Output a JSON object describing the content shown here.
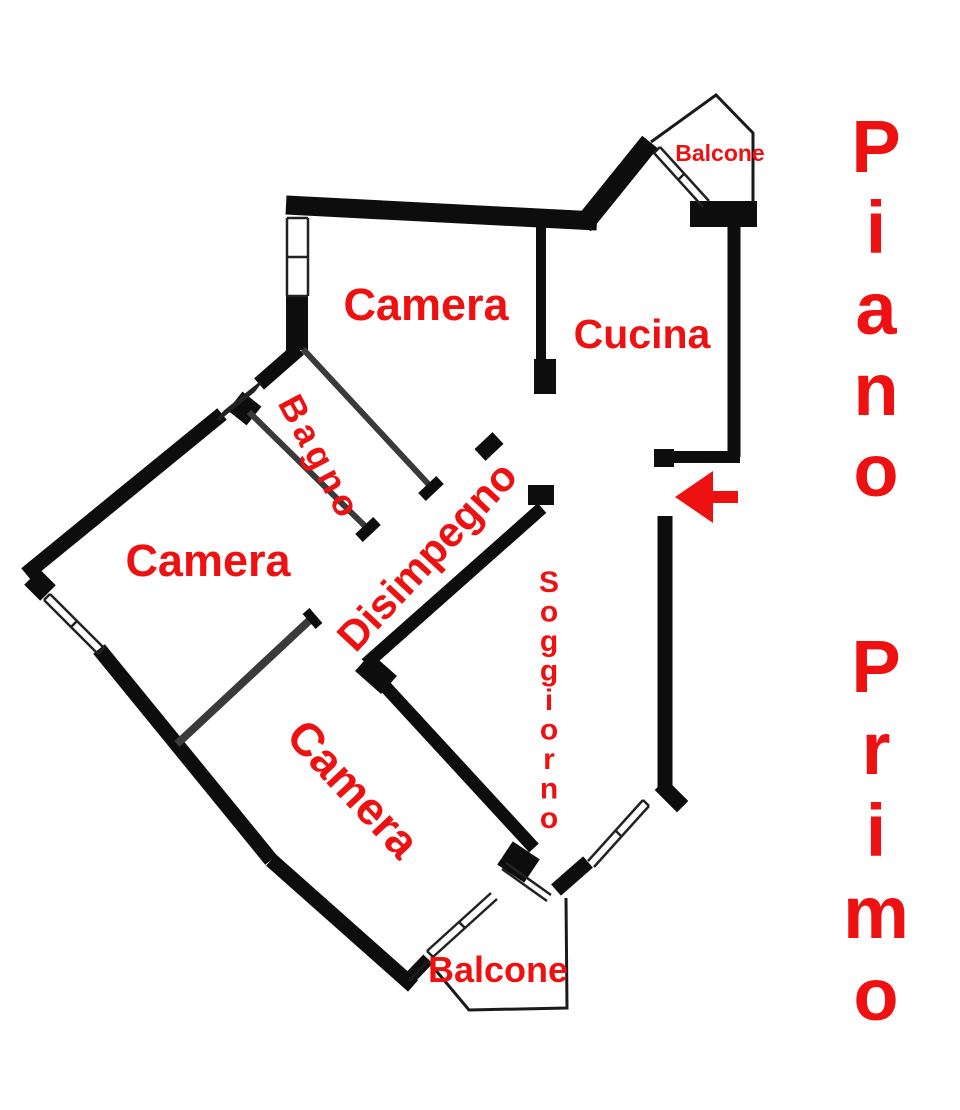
{
  "floor_title": {
    "word1": "Piano",
    "word2": "Primo"
  },
  "rooms": {
    "camera_top": "Camera",
    "cucina": "Cucina",
    "bagno": "Bagno",
    "camera_left": "Camera",
    "disimpegno": "Disimpegno",
    "soggiorno": "Soggiorno",
    "camera_bottom": "Camera",
    "balcone_top": "Balcone",
    "balcone_bottom": "Balcone"
  },
  "entrance": {
    "icon": "left-arrow"
  },
  "colors": {
    "walls": "#0d0d0d",
    "labels": "#ee1111",
    "arrow": "#ee1111",
    "background": "#ffffff"
  }
}
